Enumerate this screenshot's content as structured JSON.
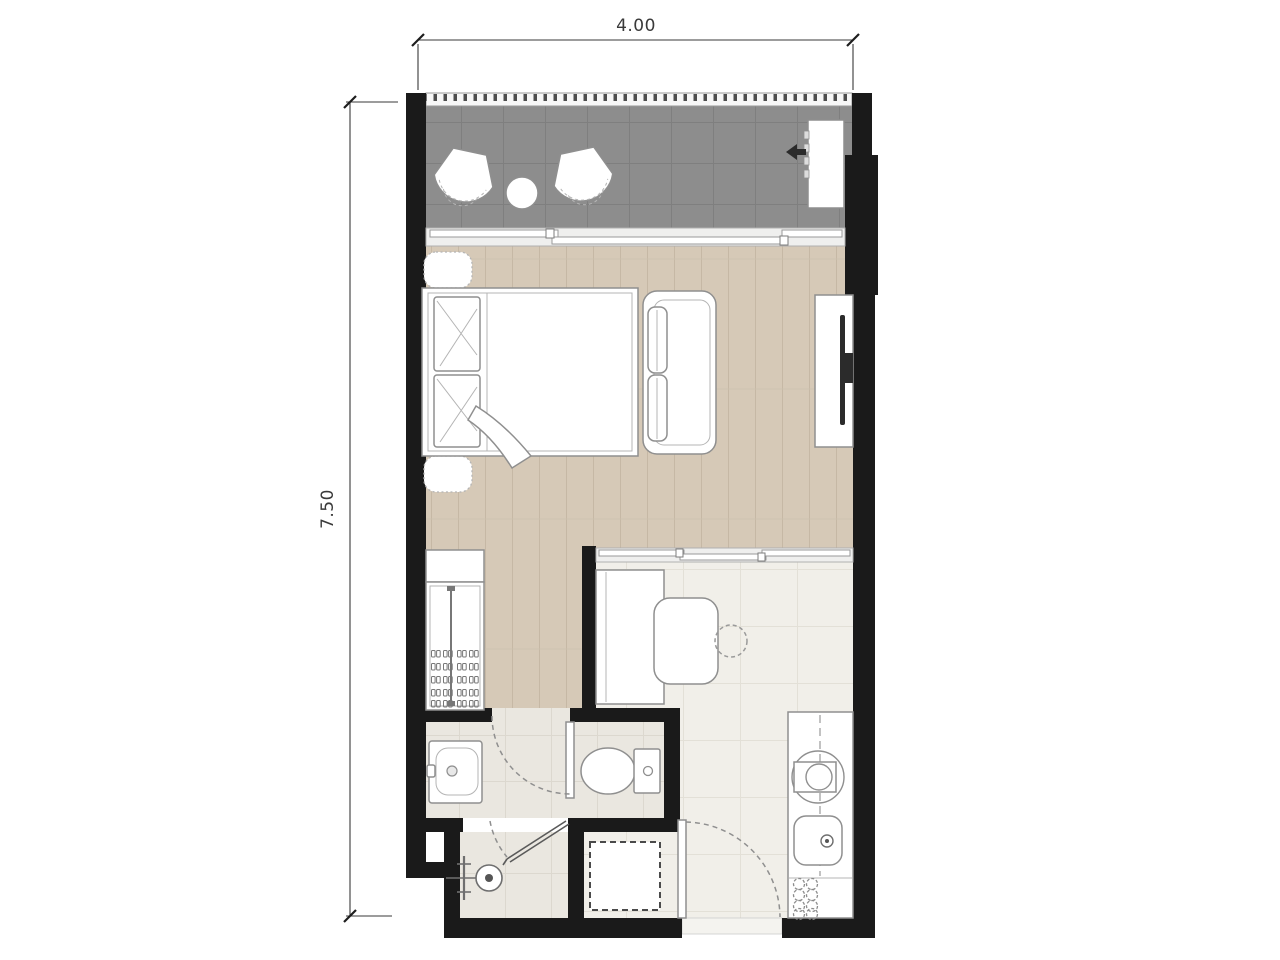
{
  "dimensions": {
    "width_label": "4.00",
    "height_label": "7.50"
  },
  "colors": {
    "background": "#ffffff",
    "wall": "#1a1a1a",
    "balcony_floor": "#8d8d8d",
    "wood_floor": "#d6c9b7",
    "tile_floor": "#f1efe9",
    "bath_floor": "#eae7e0",
    "furniture_fill": "#ffffff",
    "furniture_stroke": "#8f8f8f",
    "dimension_color": "#3a3a3a"
  }
}
